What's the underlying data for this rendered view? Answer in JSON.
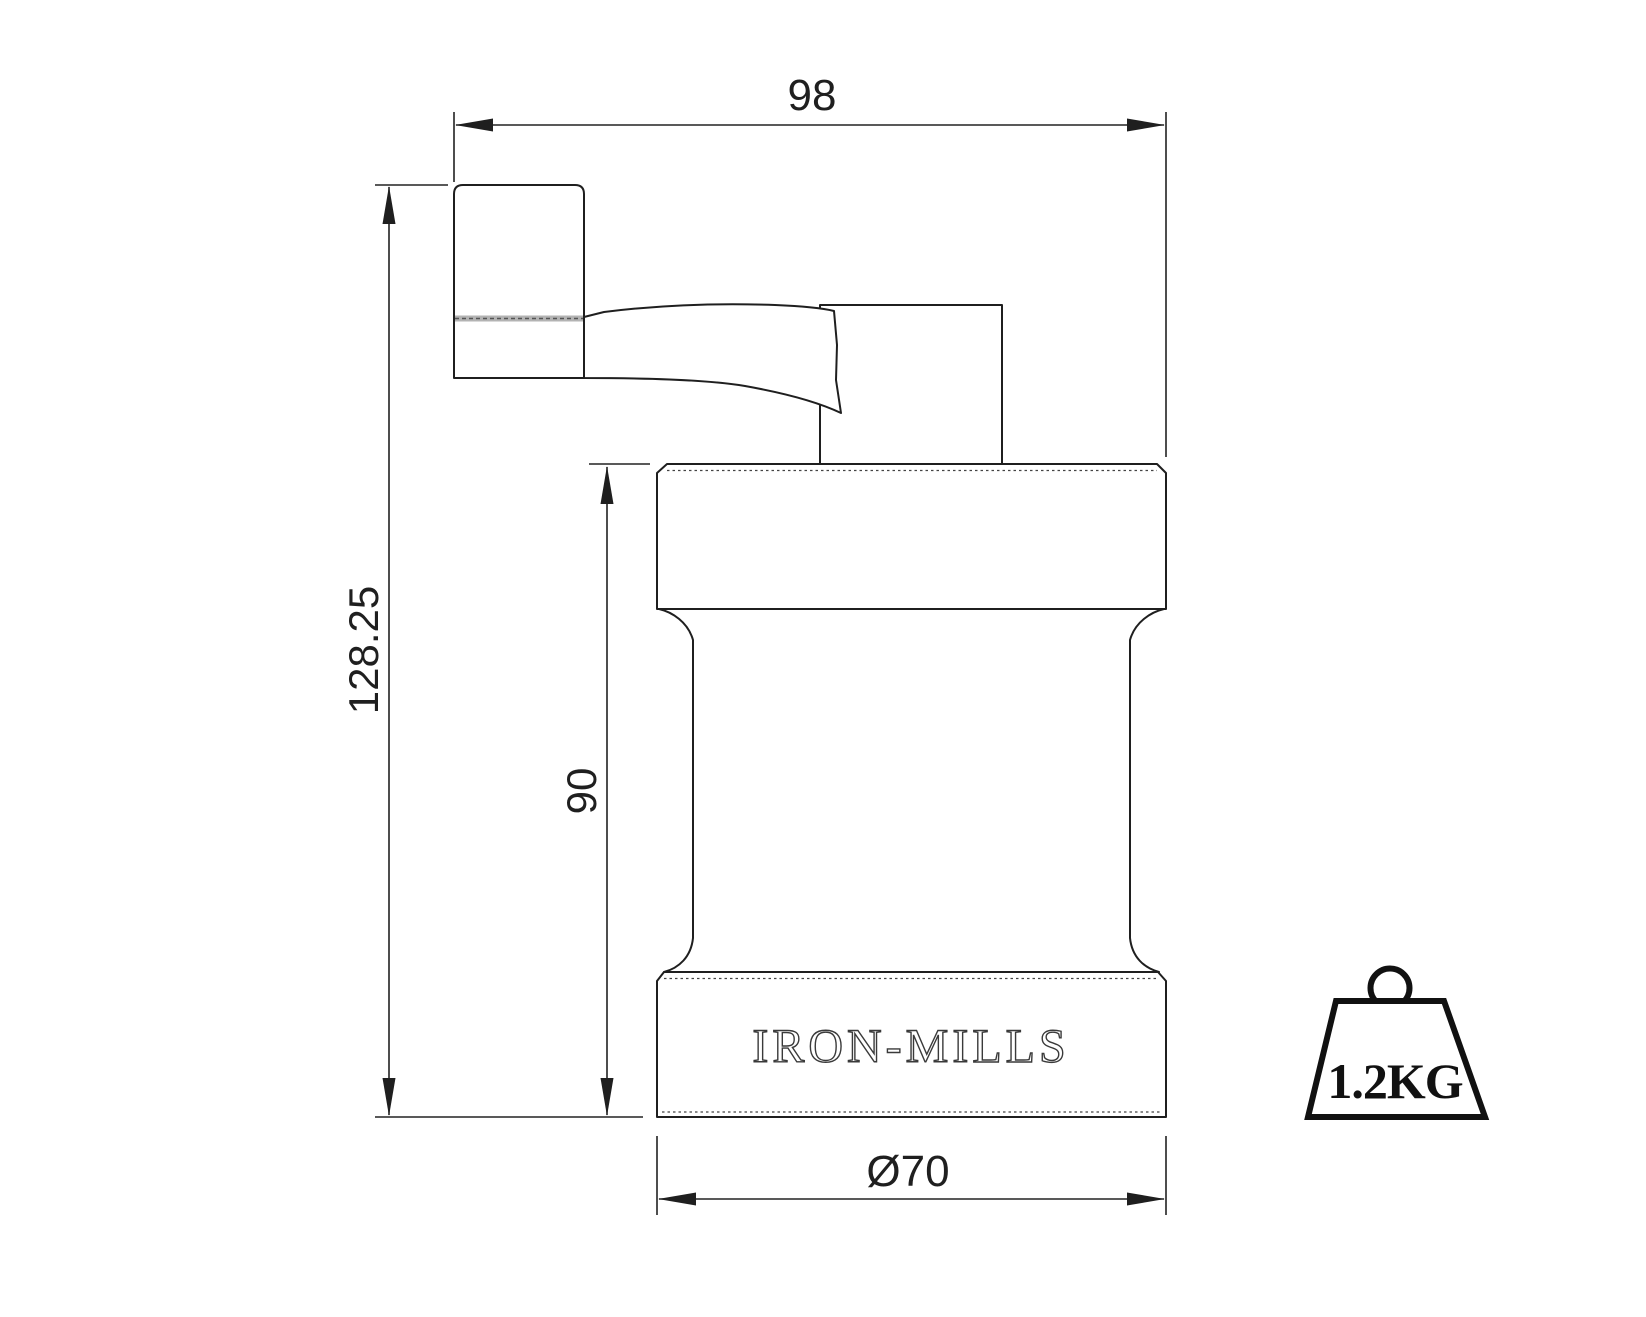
{
  "drawing": {
    "background_color": "#ffffff",
    "line_color": "#1f1f1f",
    "dimensions": {
      "overall_width": {
        "label": "98"
      },
      "overall_height": {
        "label": "128.25"
      },
      "body_height": {
        "label": "90"
      },
      "base_diameter": {
        "label": "Ø70"
      }
    },
    "engraving": {
      "brand": "IRON-MILLS"
    },
    "weight_badge": {
      "label": "1.2KG"
    }
  }
}
